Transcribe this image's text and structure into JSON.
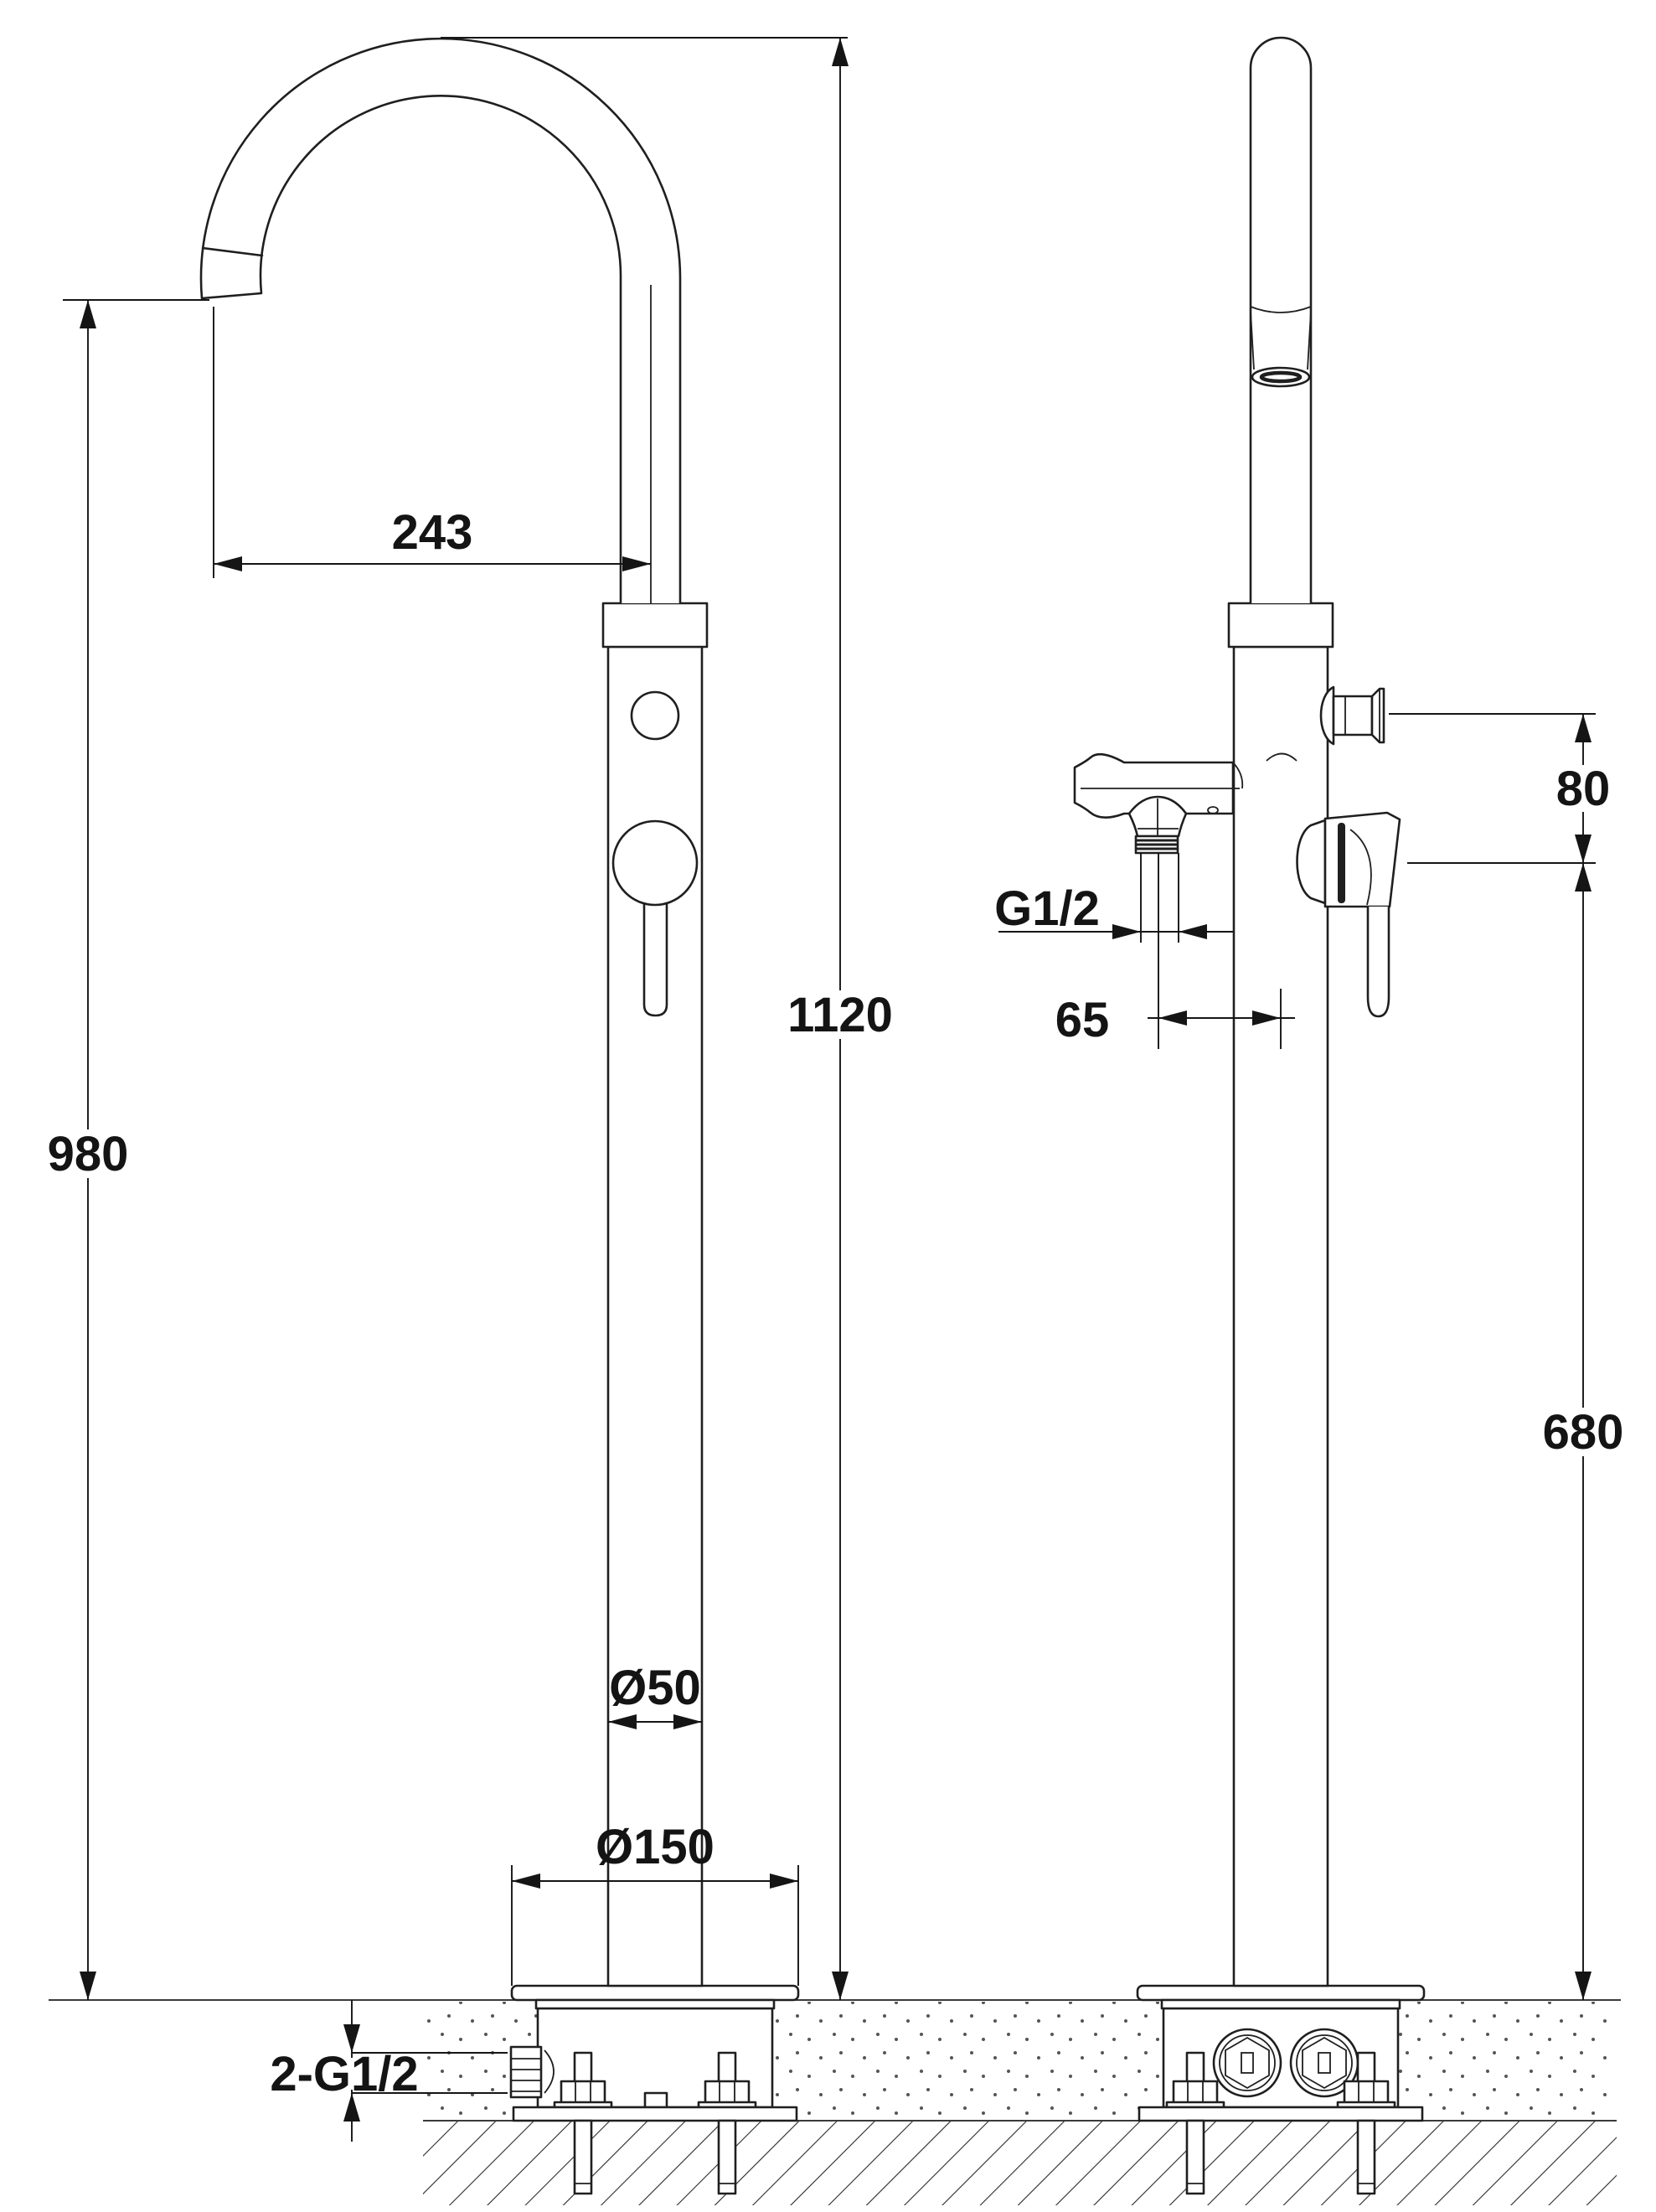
{
  "drawing": {
    "type": "technical-dimension-drawing",
    "subject": "freestanding bathtub faucet, front and side orthographic views",
    "colors": {
      "background": "#ffffff",
      "line": "#1f1f1f",
      "dimension": "#151515"
    },
    "dimensions": {
      "spout_reach": "243",
      "overall_height": "1120",
      "spout_outlet_height": "980",
      "handshower_height": "680",
      "knob_handle_offset": "80",
      "handshower_thread": "G1/2",
      "holder_offset": "65",
      "column_diameter": "Ø50",
      "base_plate_diameter": "Ø150",
      "floor_inlet_threads": "2-G1/2"
    }
  }
}
